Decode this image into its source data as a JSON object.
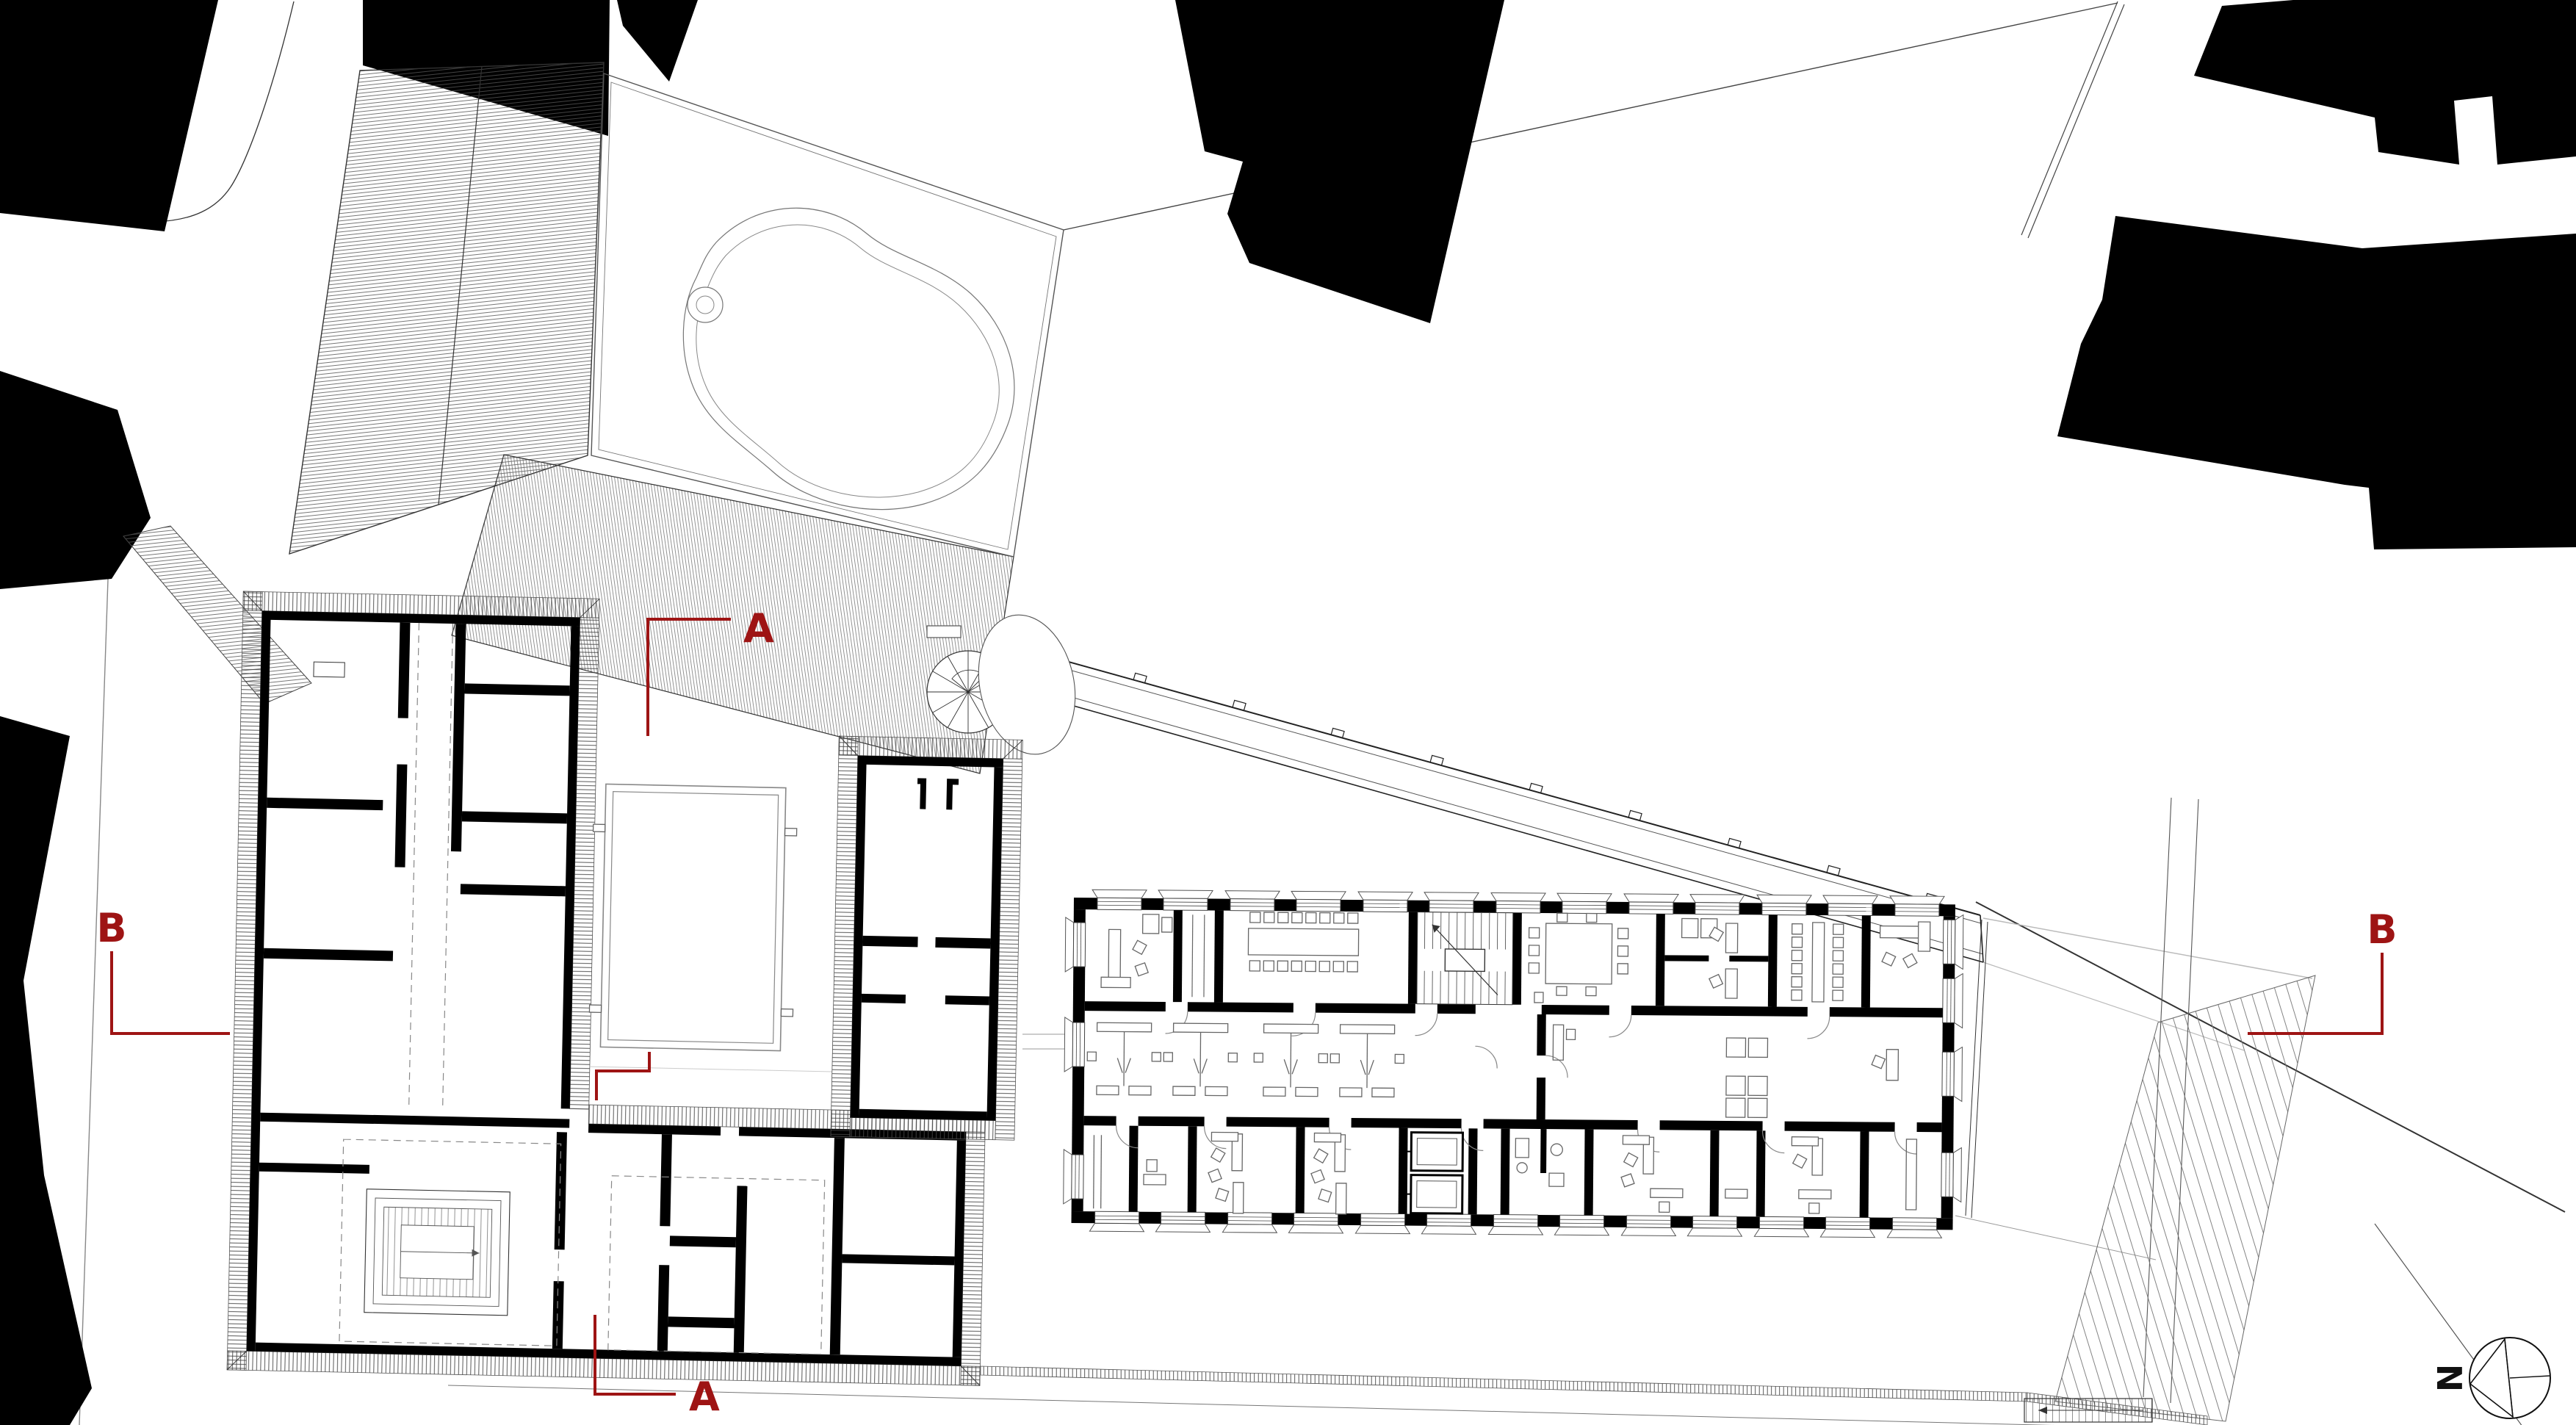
{
  "page": {
    "type": "architectural-site-plan",
    "background": "#ffffff"
  },
  "labels": {
    "section_a_top": "A",
    "section_a_bottom": "A",
    "section_b_left": "B",
    "section_b_right": "B",
    "north": "N"
  },
  "colors": {
    "section_marker": "#9e1414",
    "building_fill": "#000000",
    "wall_black": "#000000",
    "line_dark": "#333333",
    "line_light": "#999999",
    "background": "#ffffff"
  },
  "icons": [
    {
      "name": "north-arrow",
      "glyph": "circle-with-west-pointing-triangle"
    },
    {
      "name": "spiral-stair-icon",
      "glyph": "radial-segmented-circle"
    },
    {
      "name": "tree-icon",
      "glyph": "ellipse-outline"
    }
  ],
  "section_lines": [
    {
      "id": "A-A",
      "label": "A"
    },
    {
      "id": "B-B",
      "label": "B"
    }
  ]
}
